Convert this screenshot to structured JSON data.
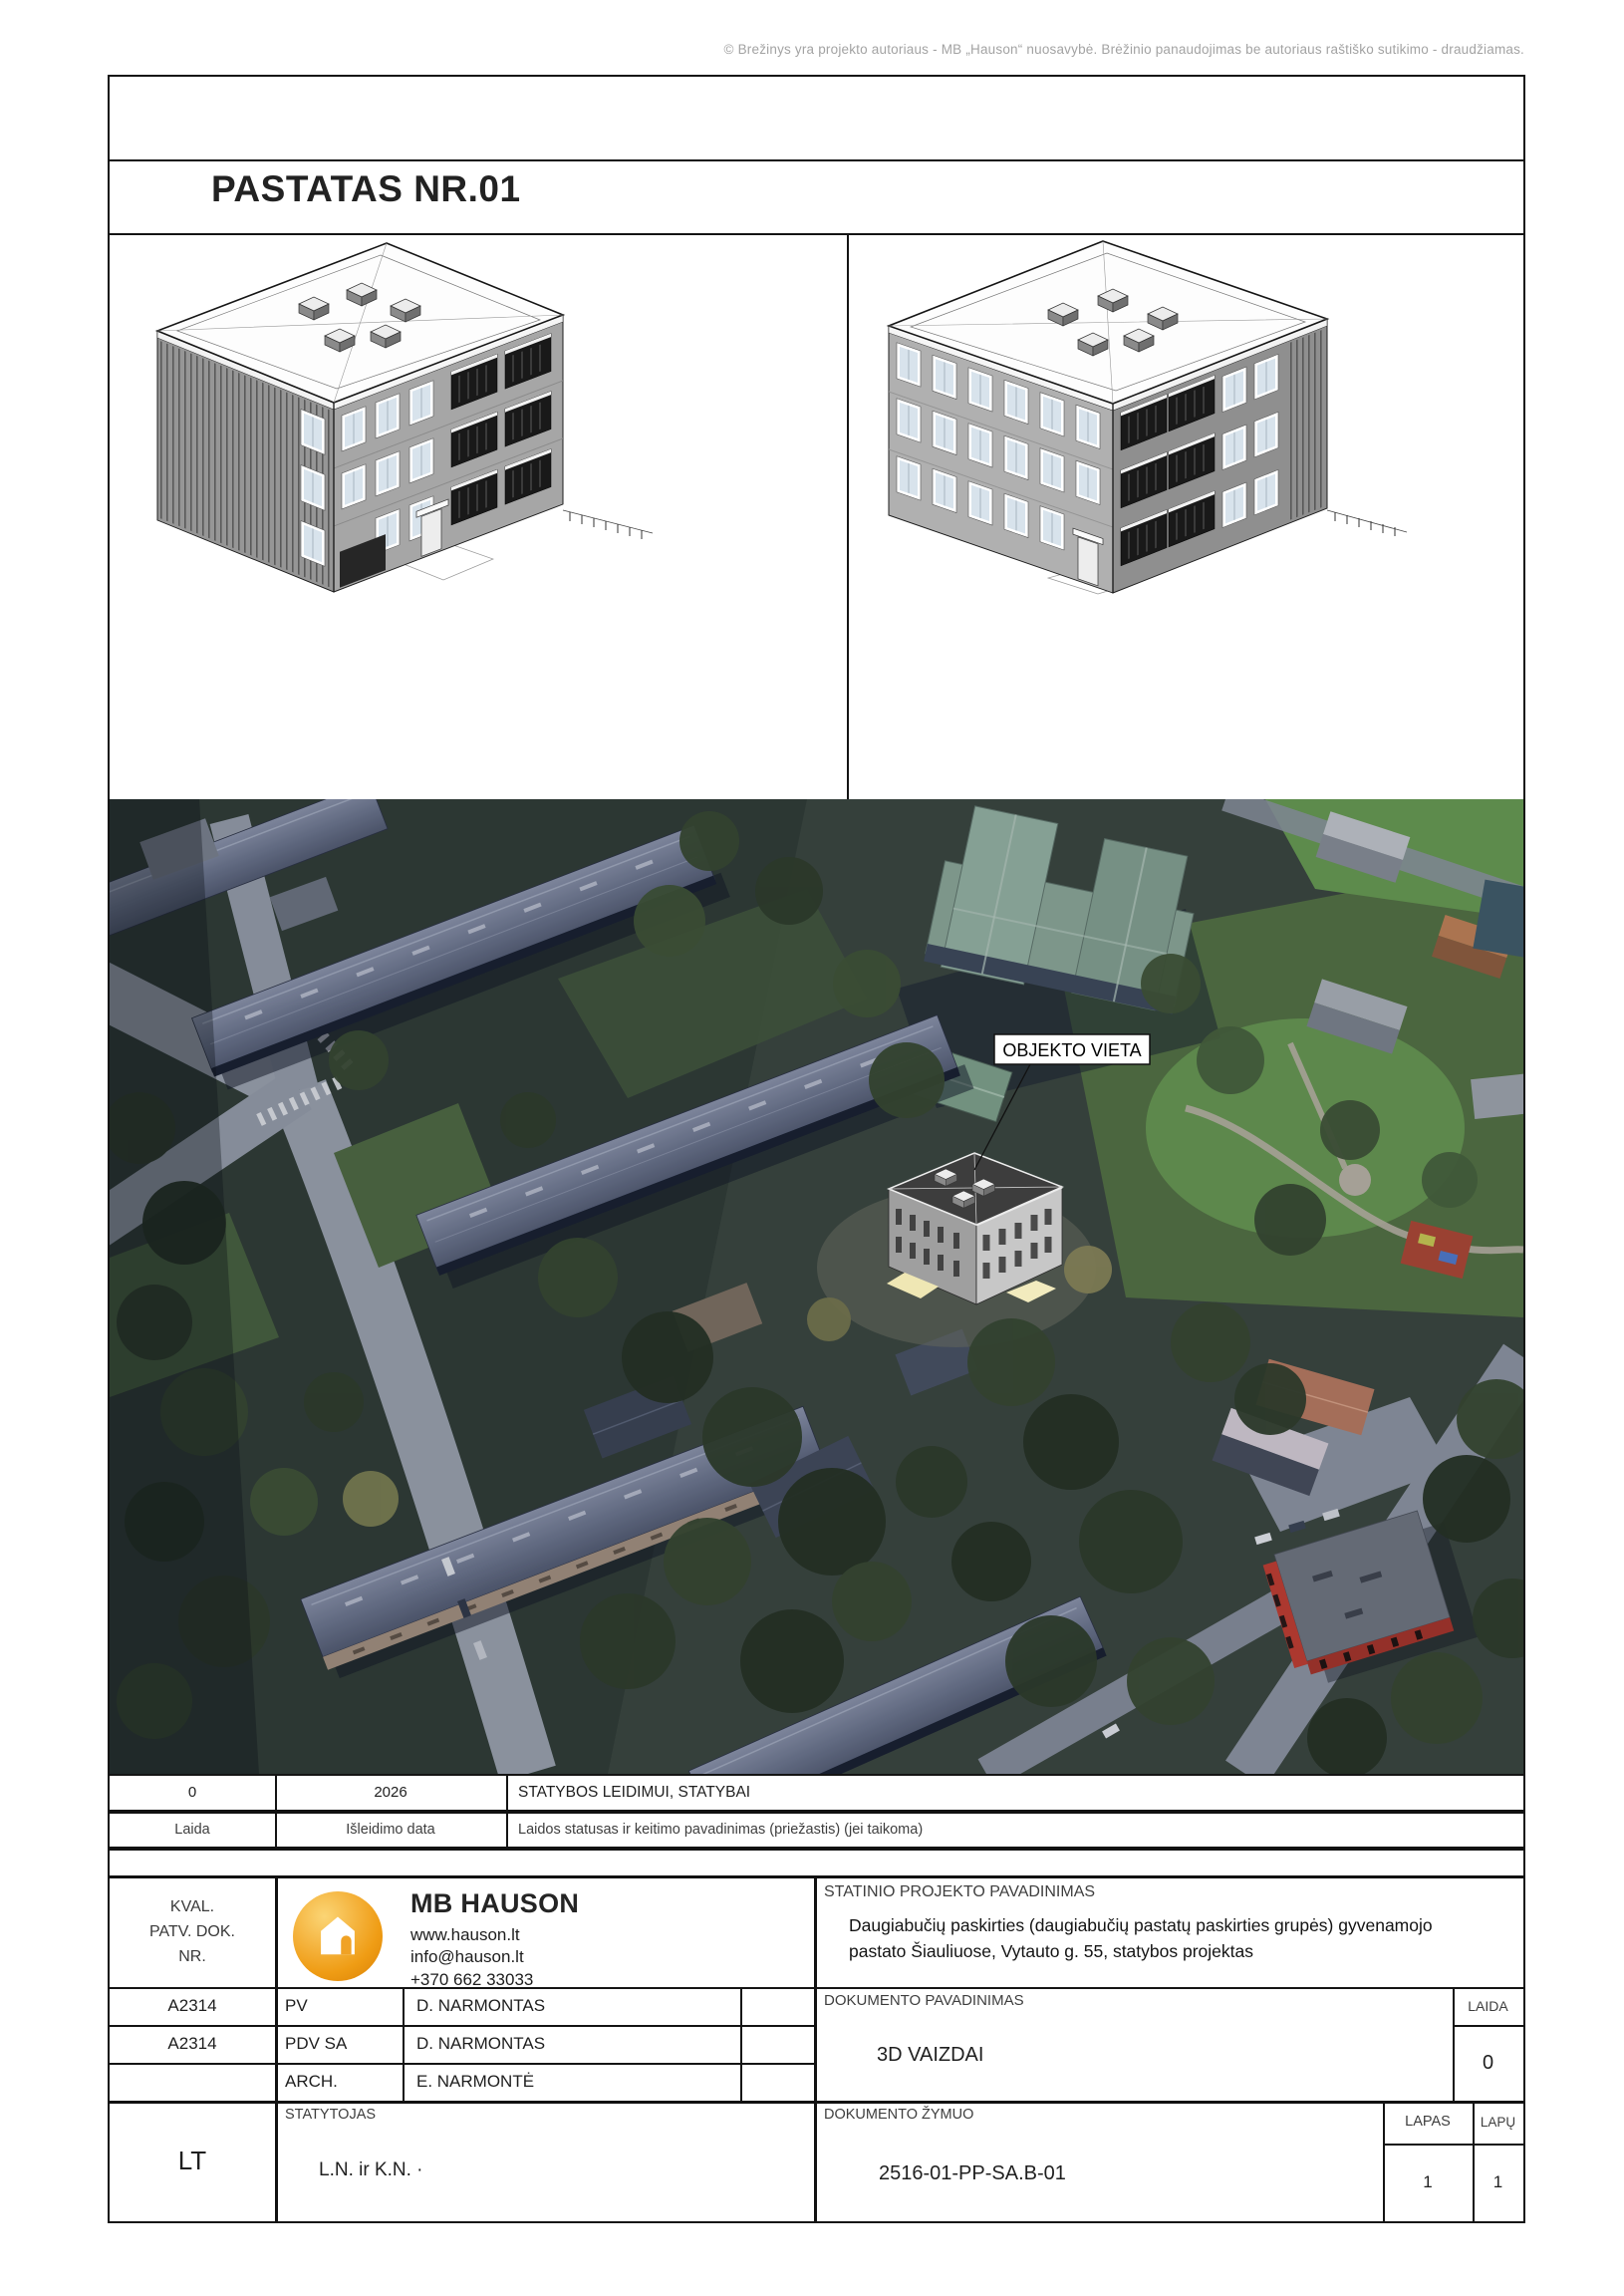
{
  "page": {
    "copyright": "© Brežinys yra projekto autoriaus - MB „Hauson“ nuosavybė. Brėžinio panaudojimas be autoriaus raštiško sutikimo - draudžiamas.",
    "sheet_title": "PASTATAS NR.01"
  },
  "map": {
    "location_label": "OBJEKTO VIETA"
  },
  "revision_table": {
    "rows": [
      {
        "laida": "0",
        "issue_date": "2026",
        "status": "STATYBOS LEIDIMUI, STATYBAI"
      },
      {
        "laida": "Laida",
        "issue_date": "Išleidimo data",
        "status": "Laidos statusas ir keitimo pavadinimas (priežastis) (jei taikoma)"
      }
    ]
  },
  "title_block": {
    "kval_lines": [
      "KVAL.",
      "PATV. DOK.",
      "NR."
    ],
    "company": {
      "name": "MB HAUSON",
      "website": "www.hauson.lt",
      "email": "info@hauson.lt",
      "phone": "+370 662 33033"
    },
    "project_label": "STATINIO PROJEKTO PAVADINIMAS",
    "project_name": "Daugiabučių paskirties (daugiabučių pastatų paskirties grupės) gyvenamojo pastato Šiauliuose, Vytauto g. 55, statybos projektas",
    "staff": [
      {
        "code": "A2314",
        "role": "PV",
        "name": "D. NARMONTAS"
      },
      {
        "code": "A2314",
        "role": "PDV SA",
        "name": "D. NARMONTAS"
      },
      {
        "code": "",
        "role": "ARCH.",
        "name": "E. NARMONTĖ"
      }
    ],
    "document_label": "DOKUMENTO PAVADINIMAS",
    "document_name": "3D VAIZDAI",
    "laida_label": "LAIDA",
    "laida_value": "0",
    "language": "LT",
    "statytojas_label": "STATYTOJAS",
    "statytojas_value": "L.N. ir K.N. ·",
    "zymuo_label": "DOKUMENTO ŽYMUO",
    "zymuo_value": "2516-01-PP-SA.B-01",
    "lapas_label": "LAPAS",
    "lapas_value": "1",
    "lapu_label": "LAPŲ",
    "lapu_value": "1"
  },
  "colors": {
    "logo_orange": "#f2a71b",
    "park_green": "#55763f",
    "school_roof_teal": "#8ba795",
    "red_building": "#bf3a2b",
    "road_gray": "#9aa1ab"
  }
}
